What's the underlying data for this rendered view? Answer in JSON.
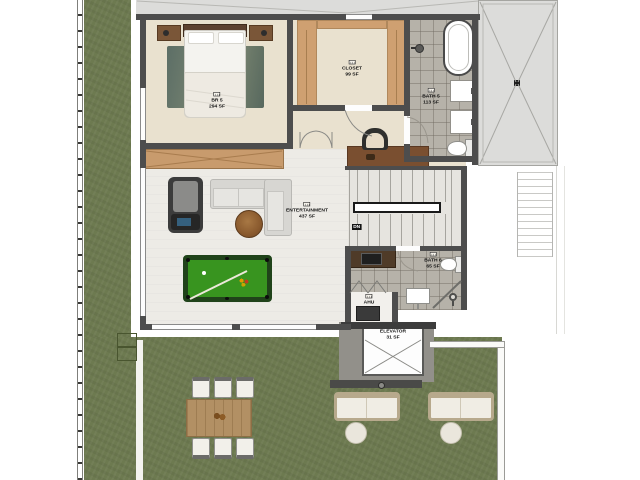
{
  "plan": {
    "type": "residential-floor-plan",
    "rooms": [
      {
        "name": "BR 5",
        "area": "294 SF"
      },
      {
        "name": "CLOSET",
        "area": "99 SF"
      },
      {
        "name": "BATH 5",
        "area": "113 SF"
      },
      {
        "name": "ENTERTAINMENT",
        "area": "437 SF"
      },
      {
        "name": "BATH 6",
        "area": "65 SF"
      },
      {
        "name": "AHU"
      },
      {
        "name": "ELEVATOR",
        "area": "31 SF"
      }
    ],
    "stairs": {
      "direction_label": "DN"
    },
    "colors": {
      "grass": "#6d7a50",
      "floor_beige": "#e9e1cf",
      "floor_light": "#edebe6",
      "tile": "#b6b2a9",
      "wall": "#4d4d4d",
      "wood": "#cfa071",
      "pool_felt": "#38941f",
      "roof": "#dcdcda"
    }
  }
}
